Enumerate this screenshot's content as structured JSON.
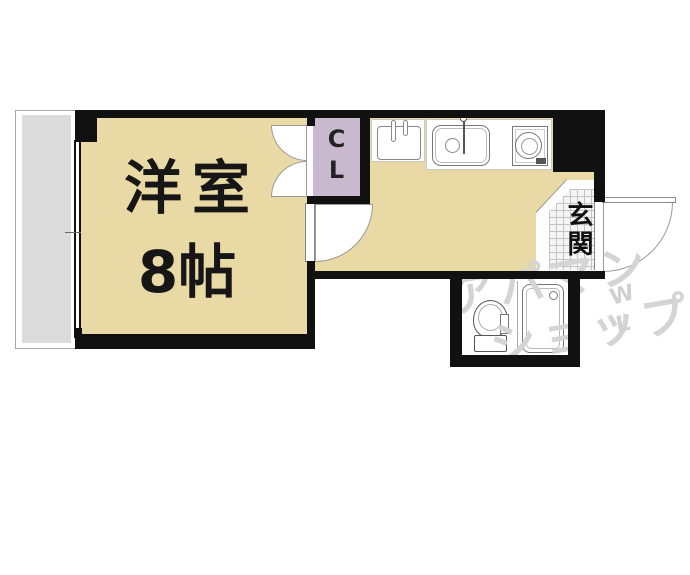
{
  "floorplan": {
    "type": "apartment-floor-plan",
    "main_room": {
      "name": "洋室",
      "size": "8帖"
    },
    "closet": {
      "abbr_line1": "C",
      "abbr_line2": "L"
    },
    "entrance": {
      "label": "玄関"
    },
    "kitchen": {
      "fixtures": [
        "washer-space",
        "kitchen-sink",
        "gas-stove"
      ]
    },
    "bathroom": {
      "fixtures": [
        "toilet",
        "bathtub"
      ]
    },
    "watermark": {
      "line1": "アパマン",
      "line2": "ショップ",
      "mark_top": "W",
      "mark_bottom": "L"
    },
    "colors": {
      "floor": "#E9D9A5",
      "closet": "#C8B9CF",
      "balcony": "#DCDCDC",
      "wall": "#111111",
      "entrance_tile_line": "#C3C3C3",
      "watermark": "#D4D4D4"
    }
  }
}
